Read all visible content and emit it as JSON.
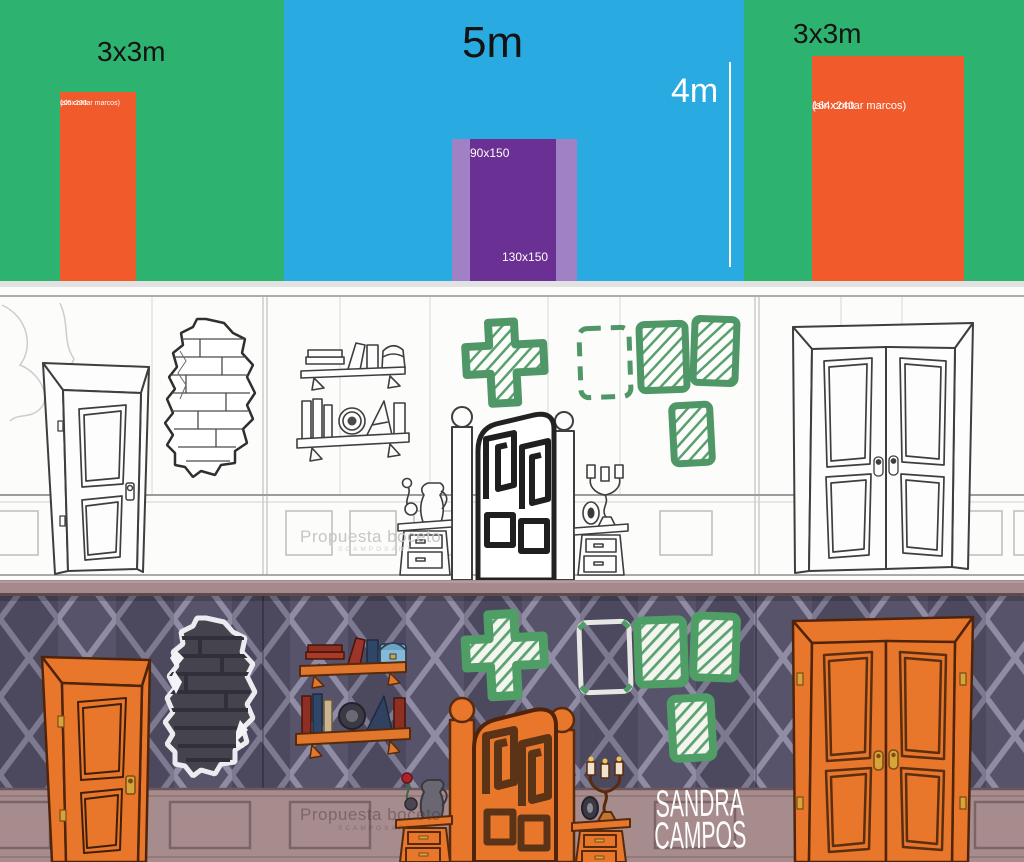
{
  "schematic": {
    "left_wall": {
      "label": "3x3m",
      "artwork_size": "105x203",
      "artwork_note": "(sin contar marcos)"
    },
    "center_wall": {
      "width_label": "5m",
      "height_label": "4m",
      "frame_inner_size": "90x150",
      "frame_outer_size": "130x150"
    },
    "right_wall": {
      "label": "3x3m",
      "artwork_size": "164x240",
      "artwork_note": "(sin contar marcos)"
    },
    "colors": {
      "wall_green": "#2eb270",
      "wall_blue": "#29abe2",
      "artwork_orange": "#f15b2c",
      "frame_purple_dark": "#6b3094",
      "frame_purple_light": "#a181c6"
    }
  },
  "sketch_band": {
    "watermark": "Propuesta boceto",
    "watermark_sub": "SCAMPOSART",
    "accent_green": "#4f9766"
  },
  "color_band": {
    "watermark": "Propuesta boceto",
    "watermark_sub": "SCAMPOSART",
    "signature_line1": "SANDRA",
    "signature_line2": "CAMPOS",
    "colors": {
      "door_orange": "#e8772c",
      "wallpaper_base": "#57536a",
      "wallpaper_lattice": "#8f8ca4",
      "wainscot": "#a78c8e",
      "accent_green": "#4f9e66",
      "gold": "#d7a33b"
    }
  }
}
